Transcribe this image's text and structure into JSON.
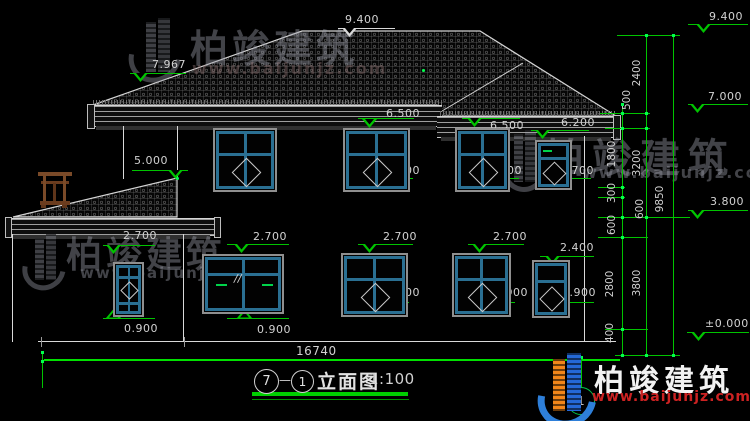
{
  "brand": {
    "name": "柏竣建筑",
    "url": "www.baijunjz.com"
  },
  "title": {
    "bubble_left": "7",
    "dash": "—",
    "bubble_right": "1",
    "name": "立面图",
    "scale": "1:100"
  },
  "total_dim": "16740",
  "axis_bubble": "1",
  "colors": {
    "green": "#00c400",
    "bright_green": "#00e000",
    "white_line": "#d9d9d9",
    "window_teal": "#2a6f92",
    "logo_blue": "#2e7fd9",
    "logo_orange": "#f08519",
    "url_red": "#cc2222"
  },
  "elevation_markers": [
    {
      "label": "9.400",
      "tx": 345,
      "ty": 13,
      "line": [
        338,
        28,
        57
      ],
      "tri": [
        342,
        28,
        "down"
      ],
      "color": "#d9d9d9"
    },
    {
      "label": "7.967",
      "tx": 152,
      "ty": 58,
      "line": [
        130,
        73,
        56
      ],
      "tri": [
        133,
        73,
        "down"
      ],
      "color": "#00c400"
    },
    {
      "label": "6.500",
      "tx": 386,
      "ty": 107,
      "line": [
        358,
        118,
        56
      ],
      "tri": [
        362,
        119,
        "down"
      ],
      "color": "#00c400"
    },
    {
      "label": "6.500",
      "tx": 490,
      "ty": 119,
      "line": [
        462,
        118,
        58
      ],
      "tri": [
        467,
        118,
        "down"
      ],
      "color": "#00c400"
    },
    {
      "label": "6.200",
      "tx": 561,
      "ty": 116,
      "line": [
        531,
        130,
        58
      ],
      "tri": [
        535,
        130,
        "down"
      ],
      "color": "#00c400"
    },
    {
      "label": "5.000",
      "tx": 134,
      "ty": 154,
      "line": [
        132,
        170,
        56
      ],
      "tri": [
        168,
        170,
        "down"
      ],
      "color": "#00c400"
    },
    {
      "label": "4.700",
      "tx": 386,
      "ty": 164,
      "line": [
        355,
        178,
        58
      ],
      "tri": [
        358,
        178,
        "down"
      ],
      "color": "#00c400"
    },
    {
      "label": "4.700",
      "tx": 488,
      "ty": 164,
      "line": [
        463,
        178,
        56
      ],
      "tri": [
        466,
        178,
        "down"
      ],
      "color": "#00c400"
    },
    {
      "label": "4.700",
      "tx": 560,
      "ty": 164,
      "line": [
        536,
        178,
        55
      ],
      "tri": [
        539,
        178,
        "down"
      ],
      "color": "#00c400"
    },
    {
      "label": "2.700",
      "tx": 123,
      "ty": 229,
      "line": [
        103,
        245,
        52
      ],
      "tri": [
        106,
        245,
        "down"
      ],
      "color": "#00c400"
    },
    {
      "label": "2.700",
      "tx": 253,
      "ty": 230,
      "line": [
        227,
        244,
        62
      ],
      "tri": [
        234,
        244,
        "down"
      ],
      "color": "#00c400"
    },
    {
      "label": "2.700",
      "tx": 383,
      "ty": 230,
      "line": [
        358,
        244,
        55
      ],
      "tri": [
        362,
        244,
        "down"
      ],
      "color": "#00c400"
    },
    {
      "label": "2.700",
      "tx": 493,
      "ty": 230,
      "line": [
        468,
        244,
        56
      ],
      "tri": [
        472,
        244,
        "down"
      ],
      "color": "#00c400"
    },
    {
      "label": "2.400",
      "tx": 560,
      "ty": 241,
      "line": [
        540,
        256,
        54
      ],
      "tri": [
        545,
        256,
        "down"
      ],
      "color": "#00c400"
    },
    {
      "label": "0.900",
      "tx": 124,
      "ty": 322,
      "line": [
        103,
        318,
        52
      ],
      "tri": [
        106,
        309,
        "up"
      ],
      "color": "#00c400"
    },
    {
      "label": "0.900",
      "tx": 257,
      "ty": 323,
      "line": [
        227,
        318,
        62
      ],
      "tri": [
        237,
        309,
        "up"
      ],
      "color": "#00c400"
    },
    {
      "label": "0.900",
      "tx": 386,
      "ty": 286,
      "line": [
        363,
        302,
        46
      ],
      "tri": [
        367,
        293,
        "down"
      ],
      "color": "#00c400"
    },
    {
      "label": "0.900",
      "tx": 494,
      "ty": 286,
      "line": [
        471,
        302,
        44
      ],
      "tri": [
        475,
        293,
        "down"
      ],
      "color": "#00c400"
    },
    {
      "label": "0.900",
      "tx": 562,
      "ty": 286,
      "line": [
        546,
        302,
        48
      ],
      "tri": [
        549,
        293,
        "down"
      ],
      "color": "#00c400"
    },
    {
      "label": "9.400",
      "tx": 709,
      "ty": 10,
      "line": [
        688,
        24,
        60
      ],
      "tri": [
        696,
        24,
        "down"
      ],
      "color": "#00c400"
    },
    {
      "label": "7.000",
      "tx": 708,
      "ty": 90,
      "line": [
        688,
        104,
        60
      ],
      "tri": [
        690,
        104,
        "down"
      ],
      "color": "#00c400"
    },
    {
      "label": "3.800",
      "tx": 710,
      "ty": 195,
      "line": [
        688,
        210,
        60
      ],
      "tri": [
        690,
        210,
        "down"
      ],
      "color": "#00c400"
    },
    {
      "label": "±0.000",
      "tx": 705,
      "ty": 317,
      "line": [
        687,
        332,
        62
      ],
      "tri": [
        691,
        332,
        "down"
      ],
      "color": "#00c400"
    }
  ],
  "chain_dims": [
    {
      "label": "2400",
      "x": 637,
      "y": 73
    },
    {
      "label": "500",
      "x": 627,
      "y": 100
    },
    {
      "label": "1800",
      "x": 612,
      "y": 154
    },
    {
      "label": "3200",
      "x": 637,
      "y": 163
    },
    {
      "label": "300",
      "x": 612,
      "y": 193
    },
    {
      "label": "600",
      "x": 640,
      "y": 209
    },
    {
      "label": "600",
      "x": 612,
      "y": 225
    },
    {
      "label": "9850",
      "x": 660,
      "y": 199
    },
    {
      "label": "2800",
      "x": 610,
      "y": 284
    },
    {
      "label": "3800",
      "x": 637,
      "y": 283
    },
    {
      "label": "400",
      "x": 610,
      "y": 333
    }
  ],
  "windows": [
    {
      "id": "w2f-1",
      "x": 213,
      "y": 128,
      "w": 64,
      "h": 64,
      "type": "t2d"
    },
    {
      "id": "w2f-2",
      "x": 343,
      "y": 128,
      "w": 67,
      "h": 64,
      "type": "t2d"
    },
    {
      "id": "w2f-3",
      "x": 455,
      "y": 128,
      "w": 55,
      "h": 64,
      "type": "t2d"
    },
    {
      "id": "w2f-4",
      "x": 535,
      "y": 140,
      "w": 37,
      "h": 50,
      "type": "small"
    },
    {
      "id": "w1f-a",
      "x": 113,
      "y": 262,
      "w": 31,
      "h": 55,
      "type": "narrow"
    },
    {
      "id": "w1f-b",
      "x": 202,
      "y": 254,
      "w": 82,
      "h": 60,
      "type": "slider"
    },
    {
      "id": "w1f-c",
      "x": 341,
      "y": 253,
      "w": 67,
      "h": 64,
      "type": "t2d"
    },
    {
      "id": "w1f-d",
      "x": 452,
      "y": 253,
      "w": 59,
      "h": 64,
      "type": "t2d"
    },
    {
      "id": "w1f-e",
      "x": 532,
      "y": 260,
      "w": 38,
      "h": 58,
      "type": "small"
    }
  ],
  "window_dashes": [
    {
      "x": 216,
      "y": 284,
      "w": 11
    },
    {
      "x": 262,
      "y": 284,
      "w": 11
    },
    {
      "x": 543,
      "y": 150,
      "w": 9
    }
  ],
  "glyphs": [
    {
      "text": "//",
      "x": 234,
      "y": 272
    }
  ],
  "lines": [
    {
      "x": 38,
      "y": 341,
      "w": 578,
      "h": 1,
      "c": "#d9d9d9"
    },
    {
      "x": 12,
      "y": 234,
      "w": 1,
      "h": 108,
      "c": "#d9d9d9"
    },
    {
      "x": 183,
      "y": 234,
      "w": 1,
      "h": 107,
      "c": "#d9d9d9"
    },
    {
      "x": 123,
      "y": 126,
      "w": 1,
      "h": 53,
      "c": "#d9d9d9"
    },
    {
      "x": 177,
      "y": 126,
      "w": 1,
      "h": 53,
      "c": "#d9d9d9"
    },
    {
      "x": 584,
      "y": 136,
      "w": 1,
      "h": 205,
      "c": "#d9d9d9"
    },
    {
      "x": 41,
      "y": 337,
      "w": 1,
      "h": 10,
      "c": "#9a9a9a"
    },
    {
      "x": 184,
      "y": 337,
      "w": 1,
      "h": 10,
      "c": "#9a9a9a"
    },
    {
      "x": 44,
      "y": 359,
      "w": 576,
      "h": 2,
      "c": "#00e000"
    },
    {
      "x": 622,
      "y": 104,
      "w": 1,
      "h": 252,
      "c": "#00c400"
    },
    {
      "x": 646,
      "y": 35,
      "w": 1,
      "h": 321,
      "c": "#00c400"
    },
    {
      "x": 673,
      "y": 35,
      "w": 1,
      "h": 321,
      "c": "#00c400"
    },
    {
      "x": 617,
      "y": 35,
      "w": 63,
      "h": 1,
      "c": "#00c400"
    },
    {
      "x": 600,
      "y": 113,
      "w": 50,
      "h": 1,
      "c": "#00c400"
    },
    {
      "x": 605,
      "y": 128,
      "w": 45,
      "h": 1,
      "c": "#00c400"
    },
    {
      "x": 598,
      "y": 187,
      "w": 27,
      "h": 1,
      "c": "#00c400"
    },
    {
      "x": 598,
      "y": 197,
      "w": 27,
      "h": 1,
      "c": "#00c400"
    },
    {
      "x": 598,
      "y": 217,
      "w": 92,
      "h": 1,
      "c": "#00c400"
    },
    {
      "x": 598,
      "y": 237,
      "w": 50,
      "h": 1,
      "c": "#00c400"
    },
    {
      "x": 605,
      "y": 329,
      "w": 43,
      "h": 1,
      "c": "#00c400"
    },
    {
      "x": 615,
      "y": 355,
      "w": 65,
      "h": 1,
      "c": "#00c400"
    },
    {
      "x": 252,
      "y": 392,
      "w": 156,
      "h": 4,
      "c": "#00d000"
    },
    {
      "x": 252,
      "y": 399,
      "w": 157,
      "h": 1,
      "c": "#009000"
    },
    {
      "x": 581,
      "y": 356,
      "w": 1,
      "h": 32,
      "c": "#00c400"
    },
    {
      "x": 42,
      "y": 352,
      "w": 1,
      "h": 36,
      "c": "#00c400"
    }
  ],
  "ticks": [
    [
      622,
      104
    ],
    [
      646,
      35
    ],
    [
      673,
      35
    ],
    [
      622,
      113
    ],
    [
      646,
      113
    ],
    [
      622,
      128
    ],
    [
      646,
      128
    ],
    [
      622,
      187
    ],
    [
      622,
      197
    ],
    [
      622,
      217
    ],
    [
      646,
      217
    ],
    [
      622,
      237
    ],
    [
      622,
      329
    ],
    [
      622,
      355
    ],
    [
      646,
      355
    ],
    [
      673,
      355
    ],
    [
      581,
      357
    ],
    [
      42,
      361
    ],
    [
      42,
      352
    ]
  ],
  "green_dots": [
    [
      422,
      69
    ],
    [
      176,
      177
    ]
  ]
}
